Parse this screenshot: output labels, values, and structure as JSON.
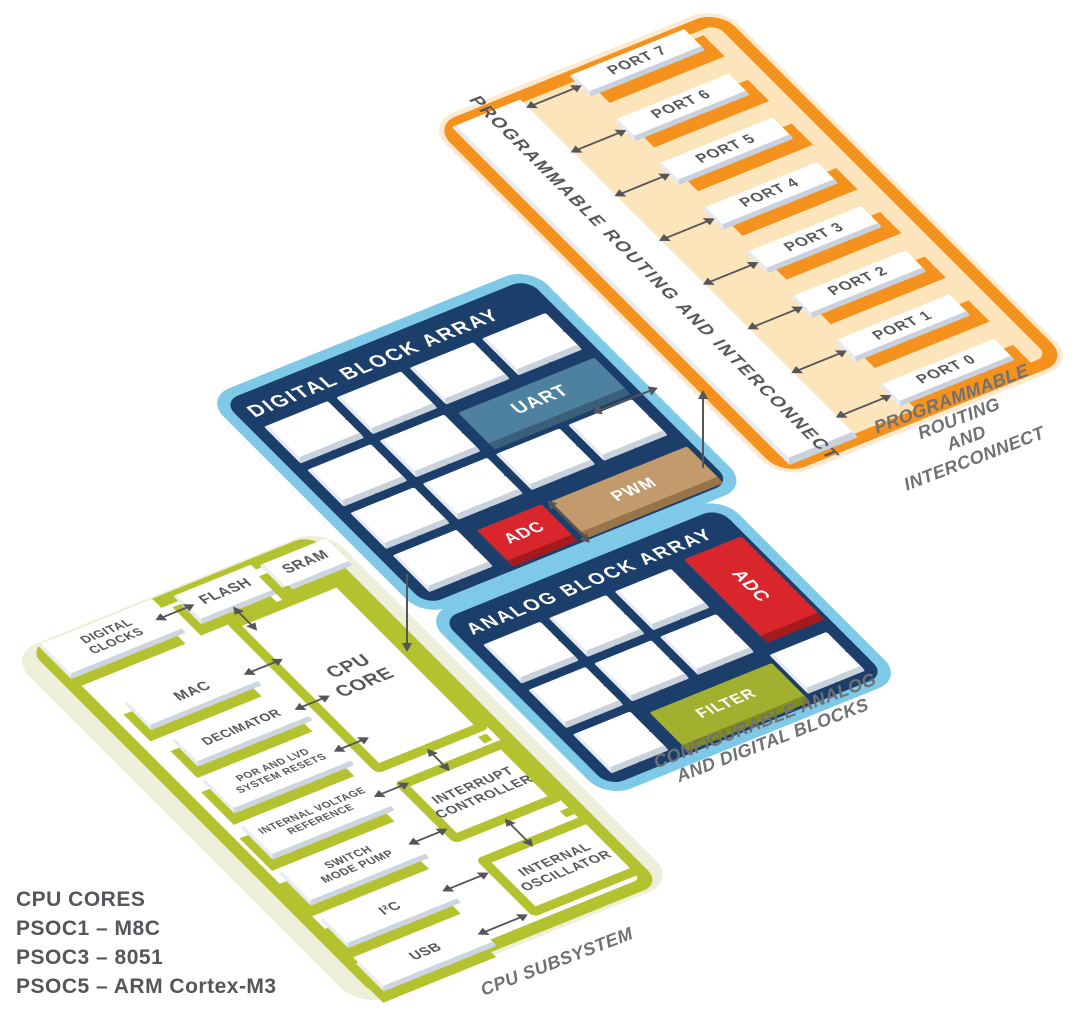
{
  "diagram": {
    "routing": {
      "bar_title": "PROGRAMMABLE ROUTING AND INTERCONNECT",
      "ports": [
        "PORT 7",
        "PORT 6",
        "PORT 5",
        "PORT 4",
        "PORT 3",
        "PORT 2",
        "PORT 1",
        "PORT 0"
      ],
      "caption": "PROGRAMMABLE ROUTING\nAND INTERCONNECT"
    },
    "digital": {
      "title": "DIGITAL BLOCK ARRAY",
      "tiles": [
        {
          "kind": "blank",
          "label": ""
        },
        {
          "kind": "blank",
          "label": ""
        },
        {
          "kind": "blank",
          "label": ""
        },
        {
          "kind": "blank",
          "label": ""
        },
        {
          "kind": "blank",
          "label": ""
        },
        {
          "kind": "blank",
          "label": ""
        },
        {
          "kind": "uart",
          "label": "UART",
          "cs": 2
        },
        {
          "kind": "blank",
          "label": ""
        },
        {
          "kind": "blank",
          "label": ""
        },
        {
          "kind": "blank",
          "label": ""
        },
        {
          "kind": "blank",
          "label": ""
        },
        {
          "kind": "blank",
          "label": ""
        },
        {
          "kind": "adc",
          "label": "ADC"
        },
        {
          "kind": "pwm",
          "label": "PWM",
          "cs": 2
        }
      ]
    },
    "analog": {
      "title": "ANALOG BLOCK ARRAY",
      "caption": "CONFIGURABLE ANALOG\nAND DIGITAL BLOCKS",
      "tiles": [
        {
          "kind": "blank",
          "label": ""
        },
        {
          "kind": "blank",
          "label": ""
        },
        {
          "kind": "blank",
          "label": ""
        },
        {
          "kind": "adcv",
          "label": "ADC",
          "rs": 2
        },
        {
          "kind": "blank",
          "label": ""
        },
        {
          "kind": "blank",
          "label": ""
        },
        {
          "kind": "blank",
          "label": ""
        },
        {
          "kind": "blank",
          "label": ""
        },
        {
          "kind": "filter",
          "label": "FILTER",
          "cs": 2
        },
        {
          "kind": "blank",
          "label": ""
        }
      ]
    },
    "cpu": {
      "caption": "CPU SUBSYSTEM",
      "bars": [
        {
          "id": "digital-clocks",
          "label": "DIGITAL\nCLOCKS"
        },
        {
          "id": "flash",
          "label": "FLASH"
        },
        {
          "id": "sram",
          "label": "SRAM"
        },
        {
          "id": "mac",
          "label": "MAC"
        },
        {
          "id": "decimator",
          "label": "DECIMATOR"
        },
        {
          "id": "por",
          "label": "POR AND LVD\nSYSTEM RESETS"
        },
        {
          "id": "ivr",
          "label": "INTERNAL VOLTAGE\nREFERENCE"
        },
        {
          "id": "smp",
          "label": "SWITCH\nMODE PUMP"
        },
        {
          "id": "i2c",
          "label": "I²C"
        },
        {
          "id": "usb",
          "label": "USB"
        }
      ],
      "blocks": [
        {
          "id": "cpu-core",
          "label": "CPU\nCORE"
        },
        {
          "id": "interrupt-controller",
          "label": "INTERRUPT\nCONTROLLER"
        },
        {
          "id": "internal-oscillator",
          "label": "INTERNAL\nOSCILLATOR"
        }
      ]
    },
    "legend": {
      "title": "CPU CORES",
      "items": [
        "PSOC1 – M8C",
        "PSOC3 – 8051",
        "PSOC5 – ARM Cortex-M3"
      ]
    },
    "icons": {
      "link_arrow": "double-headed-arrow",
      "tile_link": "paired-triangle-connector"
    },
    "colors": {
      "orange": "#F5921E",
      "orange_fill": "#FCE4BB",
      "blue": "#7EC8E8",
      "navy": "#1C3E6B",
      "olive": "#B5C22F",
      "green_fill": "#EDEFD8",
      "uart": "#4E809F",
      "adc": "#D8262C",
      "pwm": "#C29A6B",
      "filter": "#A2B02F",
      "text_gray": "#57585B",
      "caption_gray": "#707174",
      "arrow_gray": "#55565A"
    }
  }
}
